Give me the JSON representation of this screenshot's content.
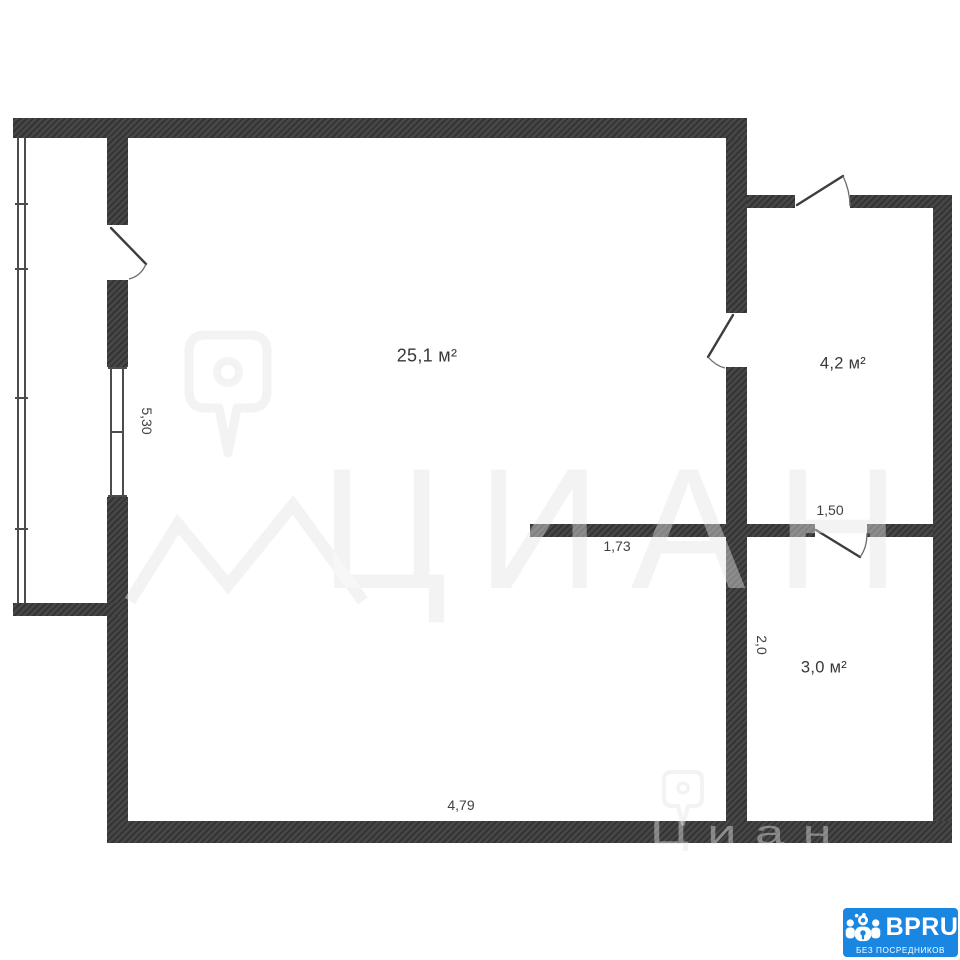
{
  "plan": {
    "wall_color": "#3c3c3c",
    "rooms": [
      {
        "id": "main-room",
        "area_label": "25,1 м²"
      },
      {
        "id": "hall-room",
        "area_label": "4,2 м²"
      },
      {
        "id": "bath-room",
        "area_label": "3,0 м²"
      }
    ],
    "dimensions": {
      "left_vertical": "5,30",
      "partition_length": "1,73",
      "hall_width": "1,50",
      "bath_height": "2,0",
      "bottom_width": "4,79"
    }
  },
  "watermark": {
    "brand_large": "ЦИАН",
    "brand_small": "Циан"
  },
  "brand_badge": {
    "title": "BPRU",
    "subtitle": "БЕЗ ПОСРЕДНИКОВ",
    "bg_color": "#1987e2"
  }
}
